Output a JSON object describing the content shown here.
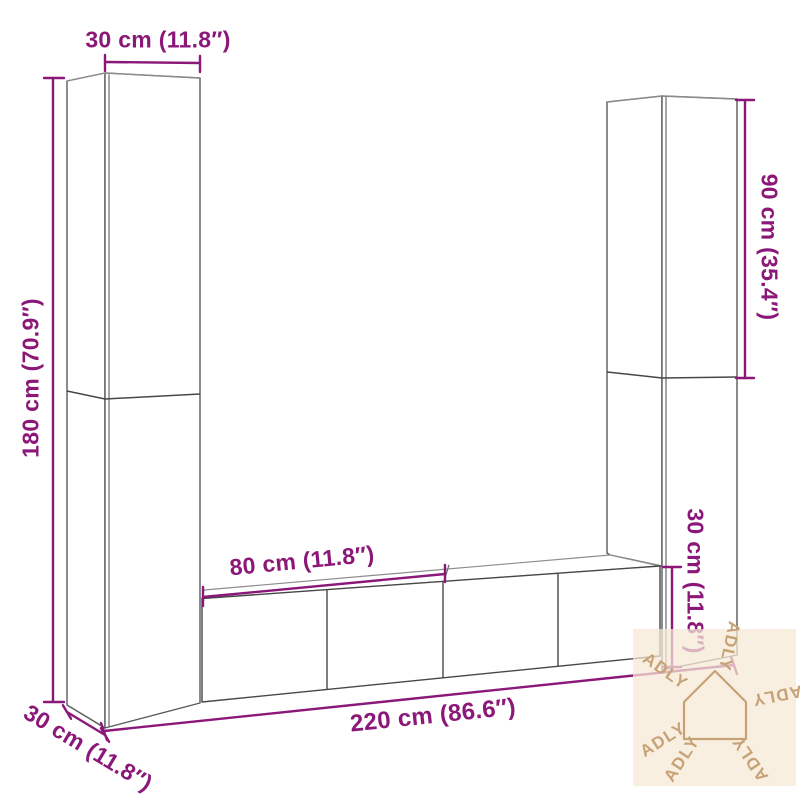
{
  "diagram": {
    "type": "furniture-dimension-diagram",
    "subject": "wall-mounted-tv-cabinet-set",
    "accent_color": "#8b1879",
    "furniture_line_color": "#555555",
    "background_color": "#ffffff",
    "dimensions": {
      "top_width": {
        "label": "30 cm (11.8″)",
        "applies_to": "left-cabinet-width"
      },
      "left_height": {
        "label": "180 cm (70.9″)",
        "applies_to": "left-cabinet-height"
      },
      "right_height": {
        "label": "90 cm (35.4″)",
        "applies_to": "right-upper-cabinet-height"
      },
      "bench_width": {
        "label": "80 cm (11.8″)",
        "applies_to": "tv-bench-section-width"
      },
      "total_width": {
        "label": "220 cm (86.6″)",
        "applies_to": "total-set-width"
      },
      "depth": {
        "label": "30 cm (11.8″)",
        "applies_to": "cabinet-depth"
      },
      "bench_height": {
        "label": "30 cm (11.8″)",
        "applies_to": "tv-bench-height"
      }
    },
    "watermark": {
      "brand": "ADLY",
      "repeat_count": 6,
      "icon": "house-icon",
      "color": "#c7a277",
      "background": "#f7ead6"
    }
  }
}
